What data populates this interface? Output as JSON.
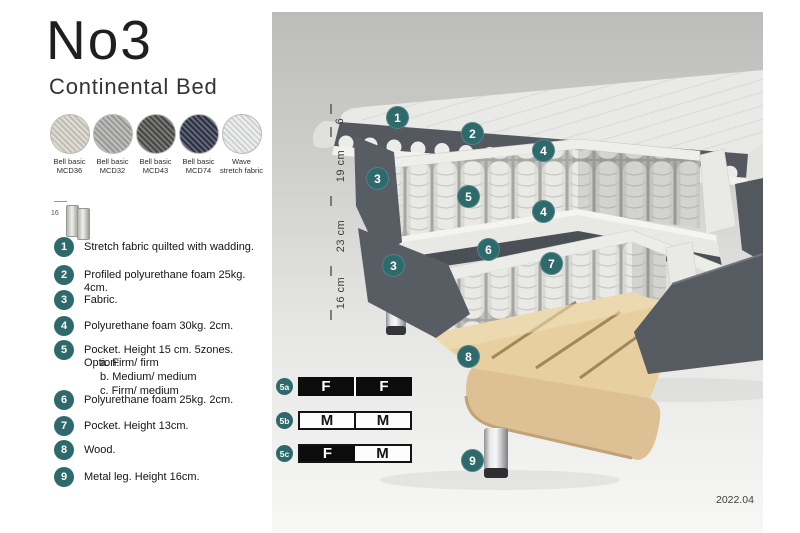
{
  "product": {
    "title": "No3",
    "subtitle": "Continental Bed"
  },
  "fabric_swatches": [
    {
      "label_line1": "Bell basic",
      "label_line2": "MCD36",
      "color": "#d6d2c8"
    },
    {
      "label_line1": "Bell basic",
      "label_line2": "MCD32",
      "color": "#a9a9a7"
    },
    {
      "label_line1": "Bell basic",
      "label_line2": "MCD43",
      "color": "#4e4e4c"
    },
    {
      "label_line1": "Bell basic",
      "label_line2": "MCD74",
      "color": "#30344a"
    },
    {
      "label_line1": "Wave",
      "label_line2": "stretch fabric",
      "color": "#e9ebeb"
    }
  ],
  "leg_icon_label": "16",
  "features": [
    {
      "num": "1",
      "text": "Stretch fabric quilted with wadding."
    },
    {
      "num": "2",
      "text": "Profiled polyurethane foam 25kg. 4cm."
    },
    {
      "num": "3",
      "text": "Fabric."
    },
    {
      "num": "4",
      "text": "Polyurethane foam 30kg. 2cm."
    },
    {
      "num": "5",
      "text": "Pocket. Height 15 cm. 5zones. Option:",
      "options": [
        "a. Firm/ firm",
        "b. Medium/ medium",
        "c. Firm/ medium"
      ]
    },
    {
      "num": "6",
      "text": "Polyurethane foam 25kg. 2cm."
    },
    {
      "num": "7",
      "text": "Pocket. Height 13cm."
    },
    {
      "num": "8",
      "text": "Wood."
    },
    {
      "num": "9",
      "text": "Metal leg. Height 16cm."
    }
  ],
  "diagram": {
    "dimension_labels": [
      "6",
      "19 cm",
      "23 cm",
      "16 cm"
    ],
    "markers": [
      {
        "label": "1"
      },
      {
        "label": "2"
      },
      {
        "label": "3"
      },
      {
        "label": "4"
      },
      {
        "label": "5"
      },
      {
        "label": "4"
      },
      {
        "label": "3"
      },
      {
        "label": "6"
      },
      {
        "label": "7"
      },
      {
        "label": "8"
      },
      {
        "label": "9"
      }
    ]
  },
  "firmness_options": [
    {
      "id": "5a",
      "cells": [
        {
          "letter": "F"
        },
        {
          "letter": "F"
        }
      ]
    },
    {
      "id": "5b",
      "cells": [
        {
          "letter": "M"
        },
        {
          "letter": "M"
        }
      ]
    },
    {
      "id": "5c",
      "cells": [
        {
          "letter": "F"
        },
        {
          "letter": "M"
        }
      ]
    }
  ],
  "version": "2022.04",
  "colors": {
    "accent_teal": "#2e696c",
    "table_black": "#0c0c0c",
    "photo_bg_top": "#bcbcbb",
    "photo_bg_bottom": "#f7f7f6"
  }
}
